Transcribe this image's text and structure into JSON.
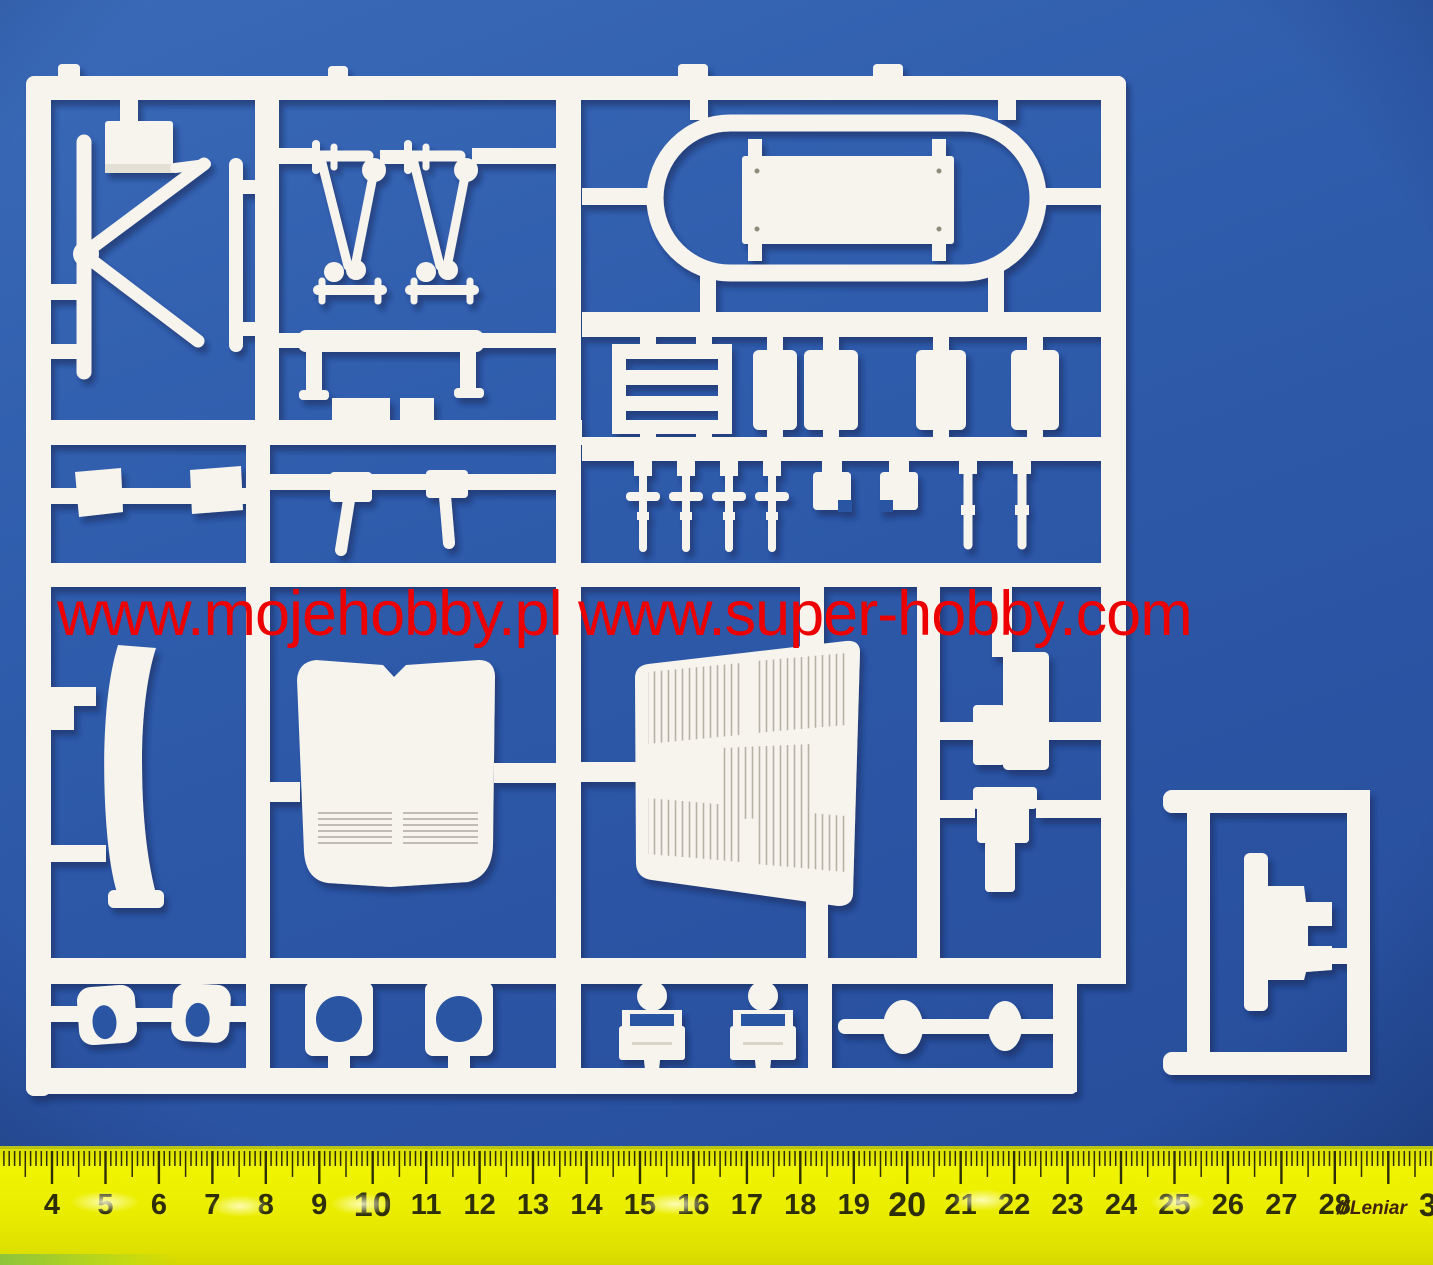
{
  "scene": {
    "background_blue": "#2d57a6",
    "sprue_white": "#f7f4ee",
    "shadow_navy": "#0c1c4e",
    "hole_blue": "#2b54a2"
  },
  "watermark": {
    "text": "www.mojehobby.pl www.super-hobby.com",
    "color": "#ec0000"
  },
  "ruler": {
    "numbers": [
      4,
      5,
      6,
      7,
      8,
      9,
      10,
      11,
      12,
      13,
      14,
      15,
      16,
      17,
      18,
      19,
      20,
      21,
      22,
      23,
      24,
      25,
      26,
      27,
      28
    ],
    "edge_digit": "3",
    "brand_prefix": "///",
    "brand": "Leniar",
    "body_color": "#eaec00",
    "number_color": "#2e2e08",
    "x_of_4cm": 52,
    "cm_px": 53.45,
    "edge_digit_x": 1419
  }
}
